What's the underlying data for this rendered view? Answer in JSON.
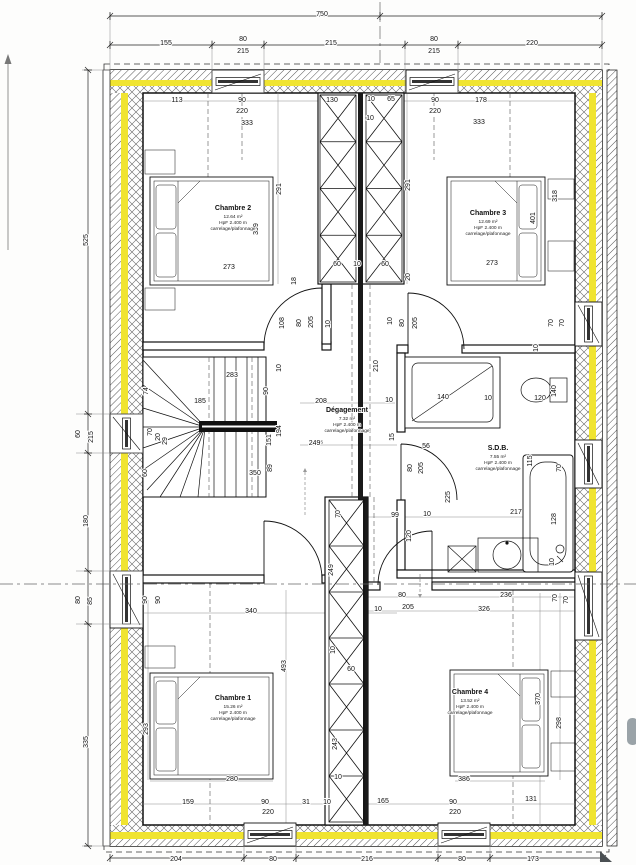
{
  "meta": {
    "type": "architectural-floor-plan",
    "floor": "étage"
  },
  "colors": {
    "insulation_yellow": "#f0e431",
    "paper": "#ffffff",
    "ink": "#1a1a1a"
  },
  "rooms": [
    {
      "id": "chambre2",
      "name": "Chambre 2",
      "area": "12.64 m²",
      "height": "HpF 2.400 m",
      "finish": "carrelage/plafonnage",
      "x": 233,
      "y": 210
    },
    {
      "id": "chambre3",
      "name": "Chambre 3",
      "area": "12.69 m²",
      "height": "HpF 2.400 m",
      "finish": "carrelage/plafonnage",
      "x": 488,
      "y": 215
    },
    {
      "id": "degagement",
      "name": "Dégagement",
      "area": "7.32 m²",
      "height": "HpF 2.400 m",
      "finish": "carrelage/plafonnage",
      "x": 347,
      "y": 412
    },
    {
      "id": "sdb",
      "name": "S.D.B.",
      "area": "7.55 m²",
      "height": "HpF 2.400 m",
      "finish": "carrelage/plafonnage",
      "x": 498,
      "y": 450
    },
    {
      "id": "chambre1",
      "name": "Chambre 1",
      "area": "15.26 m²",
      "height": "HpF 2.400 m",
      "finish": "carrelage/plafonnage",
      "x": 233,
      "y": 700
    },
    {
      "id": "chambre4",
      "name": "Chambre 4",
      "area": "13.52 m²",
      "height": "HpF 2.400 m",
      "finish": "carrelage/plafonnage",
      "x": 470,
      "y": 694
    }
  ],
  "dims": [
    {
      "t": "750",
      "x": 322,
      "y": 16,
      "v": 0
    },
    {
      "t": "155",
      "x": 166,
      "y": 45,
      "v": 0
    },
    {
      "t": "80",
      "x": 243,
      "y": 41,
      "v": 0
    },
    {
      "t": "215",
      "x": 243,
      "y": 53,
      "v": 0
    },
    {
      "t": "215",
      "x": 331,
      "y": 45,
      "v": 0
    },
    {
      "t": "80",
      "x": 434,
      "y": 41,
      "v": 0
    },
    {
      "t": "215",
      "x": 434,
      "y": 53,
      "v": 0
    },
    {
      "t": "220",
      "x": 532,
      "y": 45,
      "v": 0
    },
    {
      "t": "525",
      "x": 88,
      "y": 240,
      "v": 1
    },
    {
      "t": "60",
      "x": 80,
      "y": 434,
      "v": 1
    },
    {
      "t": "215",
      "x": 93,
      "y": 437,
      "v": 1
    },
    {
      "t": "180",
      "x": 88,
      "y": 521,
      "v": 1
    },
    {
      "t": "80",
      "x": 80,
      "y": 600,
      "v": 1
    },
    {
      "t": "85",
      "x": 92,
      "y": 601,
      "v": 1
    },
    {
      "t": "335",
      "x": 88,
      "y": 742,
      "v": 1
    },
    {
      "t": "204",
      "x": 176,
      "y": 861,
      "v": 0
    },
    {
      "t": "80",
      "x": 273,
      "y": 861,
      "v": 0
    },
    {
      "t": "216",
      "x": 367,
      "y": 861,
      "v": 0
    },
    {
      "t": "80",
      "x": 462,
      "y": 861,
      "v": 0
    },
    {
      "t": "173",
      "x": 533,
      "y": 861,
      "v": 0
    },
    {
      "t": "113",
      "x": 177,
      "y": 102,
      "v": 0
    },
    {
      "t": "90",
      "x": 242,
      "y": 102,
      "v": 0
    },
    {
      "t": "220",
      "x": 242,
      "y": 113,
      "v": 0
    },
    {
      "t": "333",
      "x": 247,
      "y": 125,
      "v": 0
    },
    {
      "t": "130",
      "x": 332,
      "y": 102,
      "v": 0
    },
    {
      "t": "10",
      "x": 371,
      "y": 101,
      "v": 0
    },
    {
      "t": "65",
      "x": 391,
      "y": 101,
      "v": 0
    },
    {
      "t": "10",
      "x": 370,
      "y": 120,
      "v": 0
    },
    {
      "t": "90",
      "x": 435,
      "y": 102,
      "v": 0
    },
    {
      "t": "220",
      "x": 435,
      "y": 113,
      "v": 0
    },
    {
      "t": "178",
      "x": 481,
      "y": 102,
      "v": 0
    },
    {
      "t": "333",
      "x": 479,
      "y": 124,
      "v": 0
    },
    {
      "t": "291",
      "x": 281,
      "y": 189,
      "v": 1
    },
    {
      "t": "399",
      "x": 258,
      "y": 229,
      "v": 1
    },
    {
      "t": "273",
      "x": 229,
      "y": 269,
      "v": 0
    },
    {
      "t": "18",
      "x": 296,
      "y": 281,
      "v": 1
    },
    {
      "t": "60",
      "x": 337,
      "y": 266,
      "v": 0
    },
    {
      "t": "10",
      "x": 357,
      "y": 266,
      "v": 0
    },
    {
      "t": "60",
      "x": 385,
      "y": 266,
      "v": 0
    },
    {
      "t": "20",
      "x": 410,
      "y": 277,
      "v": 1
    },
    {
      "t": "291",
      "x": 410,
      "y": 185,
      "v": 1
    },
    {
      "t": "401",
      "x": 535,
      "y": 218,
      "v": 1
    },
    {
      "t": "318",
      "x": 557,
      "y": 196,
      "v": 1
    },
    {
      "t": "273",
      "x": 492,
      "y": 265,
      "v": 0
    },
    {
      "t": "108",
      "x": 284,
      "y": 323,
      "v": 1
    },
    {
      "t": "80",
      "x": 301,
      "y": 323,
      "v": 1
    },
    {
      "t": "205",
      "x": 313,
      "y": 322,
      "v": 1
    },
    {
      "t": "10",
      "x": 330,
      "y": 324,
      "v": 1
    },
    {
      "t": "10",
      "x": 392,
      "y": 321,
      "v": 1
    },
    {
      "t": "80",
      "x": 404,
      "y": 323,
      "v": 1
    },
    {
      "t": "205",
      "x": 417,
      "y": 323,
      "v": 1
    },
    {
      "t": "210",
      "x": 378,
      "y": 366,
      "v": 1
    },
    {
      "t": "283",
      "x": 232,
      "y": 377,
      "v": 0
    },
    {
      "t": "185",
      "x": 200,
      "y": 403,
      "v": 0
    },
    {
      "t": "74",
      "x": 148,
      "y": 391,
      "v": 1
    },
    {
      "t": "90",
      "x": 268,
      "y": 391,
      "v": 1
    },
    {
      "t": "10",
      "x": 281,
      "y": 368,
      "v": 1
    },
    {
      "t": "194",
      "x": 281,
      "y": 431,
      "v": 1
    },
    {
      "t": "151",
      "x": 271,
      "y": 440,
      "v": 1
    },
    {
      "t": "70",
      "x": 152,
      "y": 432,
      "v": 1
    },
    {
      "t": "20",
      "x": 160,
      "y": 437,
      "v": 1
    },
    {
      "t": "29",
      "x": 167,
      "y": 441,
      "v": 1
    },
    {
      "t": "60",
      "x": 147,
      "y": 473,
      "v": 1
    },
    {
      "t": "89",
      "x": 272,
      "y": 468,
      "v": 1
    },
    {
      "t": "350",
      "x": 255,
      "y": 475,
      "v": 0
    },
    {
      "t": "208",
      "x": 321,
      "y": 403,
      "v": 0
    },
    {
      "t": "249⁵",
      "x": 316,
      "y": 445,
      "v": 0
    },
    {
      "t": "10",
      "x": 389,
      "y": 402,
      "v": 0
    },
    {
      "t": "140",
      "x": 443,
      "y": 399,
      "v": 0
    },
    {
      "t": "10",
      "x": 488,
      "y": 400,
      "v": 0
    },
    {
      "t": "120",
      "x": 540,
      "y": 400,
      "v": 0
    },
    {
      "t": "140",
      "x": 556,
      "y": 391,
      "v": 1
    },
    {
      "t": "70",
      "x": 553,
      "y": 323,
      "v": 1
    },
    {
      "t": "70",
      "x": 564,
      "y": 323,
      "v": 1
    },
    {
      "t": "10",
      "x": 538,
      "y": 348,
      "v": 1
    },
    {
      "t": "15",
      "x": 394,
      "y": 437,
      "v": 1
    },
    {
      "t": "56",
      "x": 426,
      "y": 448,
      "v": 0
    },
    {
      "t": "80",
      "x": 412,
      "y": 468,
      "v": 1
    },
    {
      "t": "205",
      "x": 423,
      "y": 468,
      "v": 1
    },
    {
      "t": "225",
      "x": 450,
      "y": 497,
      "v": 1
    },
    {
      "t": "99",
      "x": 395,
      "y": 517,
      "v": 0
    },
    {
      "t": "10",
      "x": 427,
      "y": 516,
      "v": 0
    },
    {
      "t": "217",
      "x": 516,
      "y": 514,
      "v": 0
    },
    {
      "t": "115",
      "x": 532,
      "y": 461,
      "v": 1
    },
    {
      "t": "70",
      "x": 561,
      "y": 468,
      "v": 1
    },
    {
      "t": "128",
      "x": 556,
      "y": 519,
      "v": 1
    },
    {
      "t": "10",
      "x": 554,
      "y": 562,
      "v": 1
    },
    {
      "t": "120",
      "x": 411,
      "y": 536,
      "v": 1
    },
    {
      "t": "70",
      "x": 340,
      "y": 514,
      "v": 1
    },
    {
      "t": "249",
      "x": 333,
      "y": 570,
      "v": 1
    },
    {
      "t": "10",
      "x": 335,
      "y": 650,
      "v": 1
    },
    {
      "t": "60",
      "x": 351,
      "y": 671,
      "v": 0
    },
    {
      "t": "243",
      "x": 337,
      "y": 744,
      "v": 1
    },
    {
      "t": "10",
      "x": 338,
      "y": 779,
      "v": 0
    },
    {
      "t": "90",
      "x": 147,
      "y": 600,
      "v": 1
    },
    {
      "t": "90",
      "x": 160,
      "y": 600,
      "v": 1
    },
    {
      "t": "340",
      "x": 251,
      "y": 613,
      "v": 0
    },
    {
      "t": "493",
      "x": 286,
      "y": 666,
      "v": 1
    },
    {
      "t": "293",
      "x": 148,
      "y": 729,
      "v": 1
    },
    {
      "t": "280",
      "x": 232,
      "y": 781,
      "v": 0
    },
    {
      "t": "159",
      "x": 188,
      "y": 804,
      "v": 0
    },
    {
      "t": "90",
      "x": 265,
      "y": 804,
      "v": 0
    },
    {
      "t": "220",
      "x": 268,
      "y": 814,
      "v": 0
    },
    {
      "t": "31",
      "x": 306,
      "y": 804,
      "v": 0
    },
    {
      "t": "10",
      "x": 327,
      "y": 804,
      "v": 0
    },
    {
      "t": "80",
      "x": 402,
      "y": 597,
      "v": 0
    },
    {
      "t": "205",
      "x": 408,
      "y": 609,
      "v": 0
    },
    {
      "t": "10",
      "x": 378,
      "y": 611,
      "v": 0
    },
    {
      "t": "236",
      "x": 506,
      "y": 597,
      "v": 0
    },
    {
      "t": "326",
      "x": 484,
      "y": 611,
      "v": 0
    },
    {
      "t": "70",
      "x": 557,
      "y": 598,
      "v": 1
    },
    {
      "t": "70",
      "x": 568,
      "y": 600,
      "v": 1
    },
    {
      "t": "370",
      "x": 540,
      "y": 699,
      "v": 1
    },
    {
      "t": "298",
      "x": 561,
      "y": 723,
      "v": 1
    },
    {
      "t": "386",
      "x": 464,
      "y": 781,
      "v": 0
    },
    {
      "t": "165",
      "x": 383,
      "y": 803,
      "v": 0
    },
    {
      "t": "90",
      "x": 453,
      "y": 804,
      "v": 0
    },
    {
      "t": "220",
      "x": 455,
      "y": 814,
      "v": 0
    },
    {
      "t": "131",
      "x": 531,
      "y": 801,
      "v": 0
    }
  ]
}
